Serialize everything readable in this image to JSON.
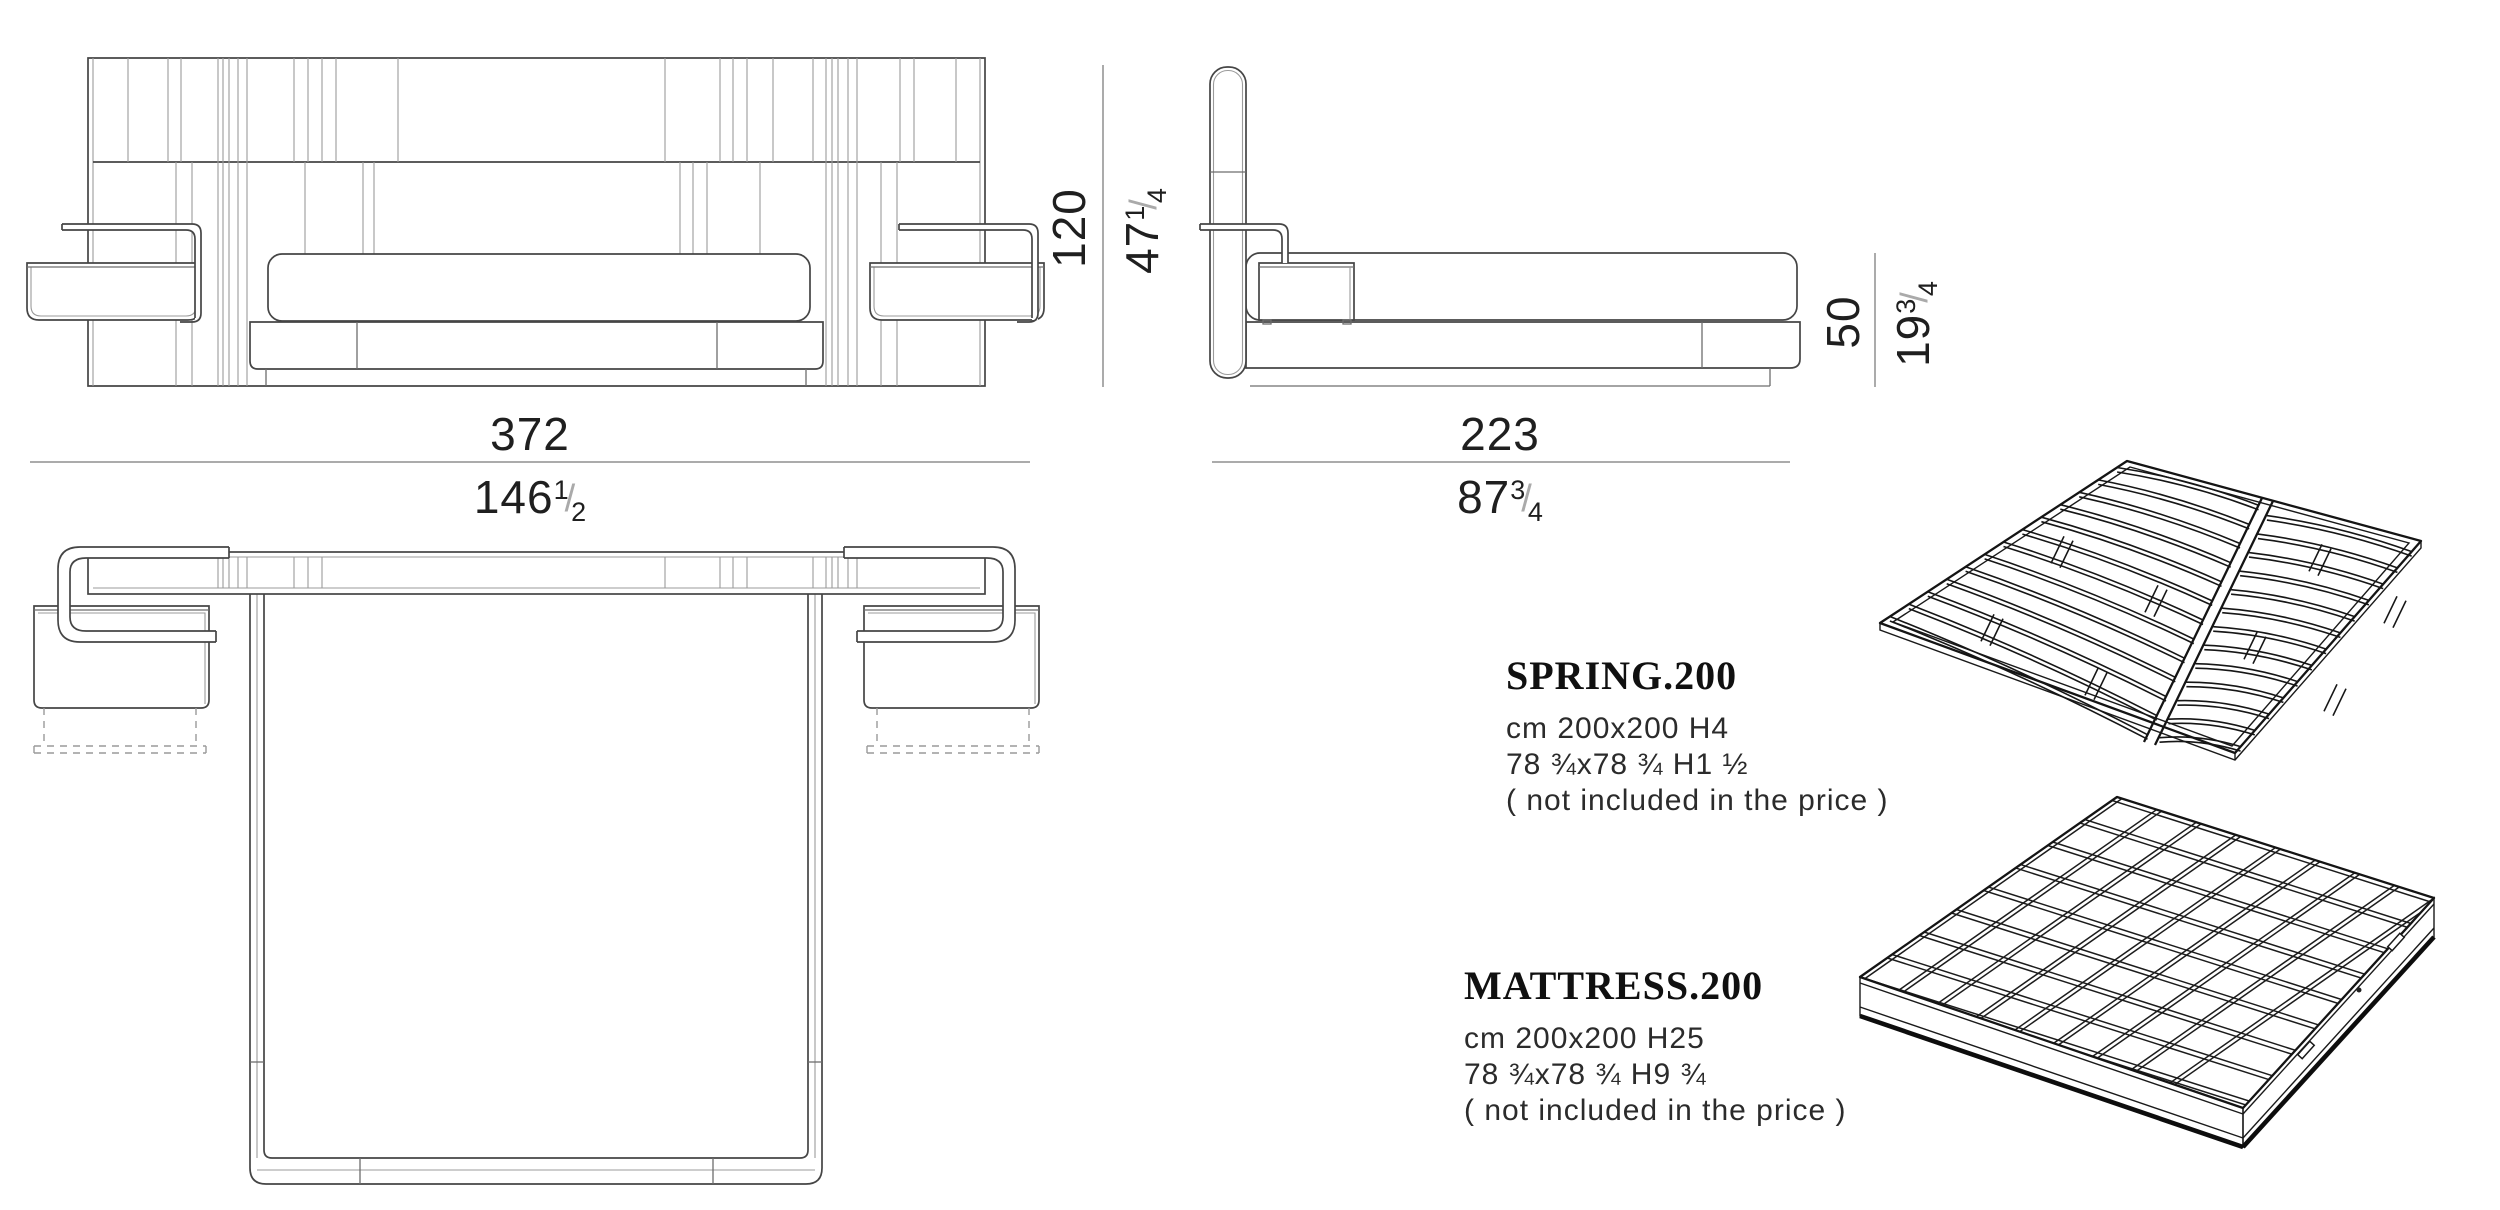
{
  "page": {
    "background": "#ffffff"
  },
  "dimensions": {
    "front_width": {
      "cm": "372",
      "inch_whole": "146",
      "inch_num": "1",
      "inch_den": "2"
    },
    "front_height": {
      "cm": "120",
      "inch_whole": "47",
      "inch_num": "1",
      "inch_den": "4"
    },
    "side_depth": {
      "cm": "223",
      "inch_whole": "87",
      "inch_num": "3",
      "inch_den": "4"
    },
    "side_seat_height": {
      "cm": "50",
      "inch_whole": "19",
      "inch_num": "3",
      "inch_den": "4"
    }
  },
  "products": [
    {
      "name": "SPRING.200",
      "size_cm": "cm 200x200 H4",
      "size_in": "78 ¾x78 ¾ H1 ½",
      "note": "( not included in the price )"
    },
    {
      "name": "MATTRESS.200",
      "size_cm": "cm 200x200 H25",
      "size_in": "78 ¾x78 ¾ H9 ¾",
      "note": "( not included in the price )"
    }
  ]
}
